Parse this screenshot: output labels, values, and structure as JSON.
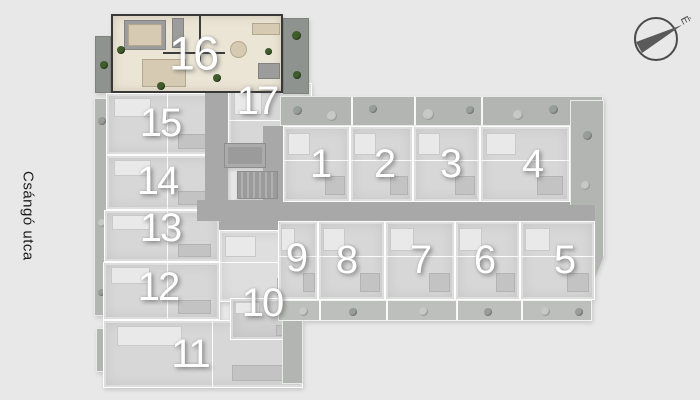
{
  "street_label": "Csángó utca",
  "compass": {
    "north_label": "É"
  },
  "floorplan": {
    "selected_unit": "16",
    "units": [
      {
        "label": "1",
        "x": 320,
        "y": 164
      },
      {
        "label": "2",
        "x": 384,
        "y": 164
      },
      {
        "label": "3",
        "x": 450,
        "y": 164
      },
      {
        "label": "4",
        "x": 532,
        "y": 164
      },
      {
        "label": "5",
        "x": 564,
        "y": 260
      },
      {
        "label": "6",
        "x": 484,
        "y": 260
      },
      {
        "label": "7",
        "x": 420,
        "y": 260
      },
      {
        "label": "8",
        "x": 346,
        "y": 260
      },
      {
        "label": "9",
        "x": 296,
        "y": 258
      },
      {
        "label": "10",
        "x": 262,
        "y": 303
      },
      {
        "label": "11",
        "x": 190,
        "y": 354
      },
      {
        "label": "12",
        "x": 158,
        "y": 287
      },
      {
        "label": "13",
        "x": 160,
        "y": 228
      },
      {
        "label": "14",
        "x": 157,
        "y": 181
      },
      {
        "label": "15",
        "x": 160,
        "y": 123
      },
      {
        "label": "16",
        "x": 193,
        "y": 53
      },
      {
        "label": "17",
        "x": 257,
        "y": 101
      }
    ],
    "colors": {
      "background": "#e8e8e8",
      "building": "#d7d7d7",
      "corridor": "#a8a8a8",
      "terrace": "#b2b5b2",
      "highlight": "#ebe5d6",
      "plant_green": "#3f5c2b",
      "number": "#ffffff"
    }
  }
}
